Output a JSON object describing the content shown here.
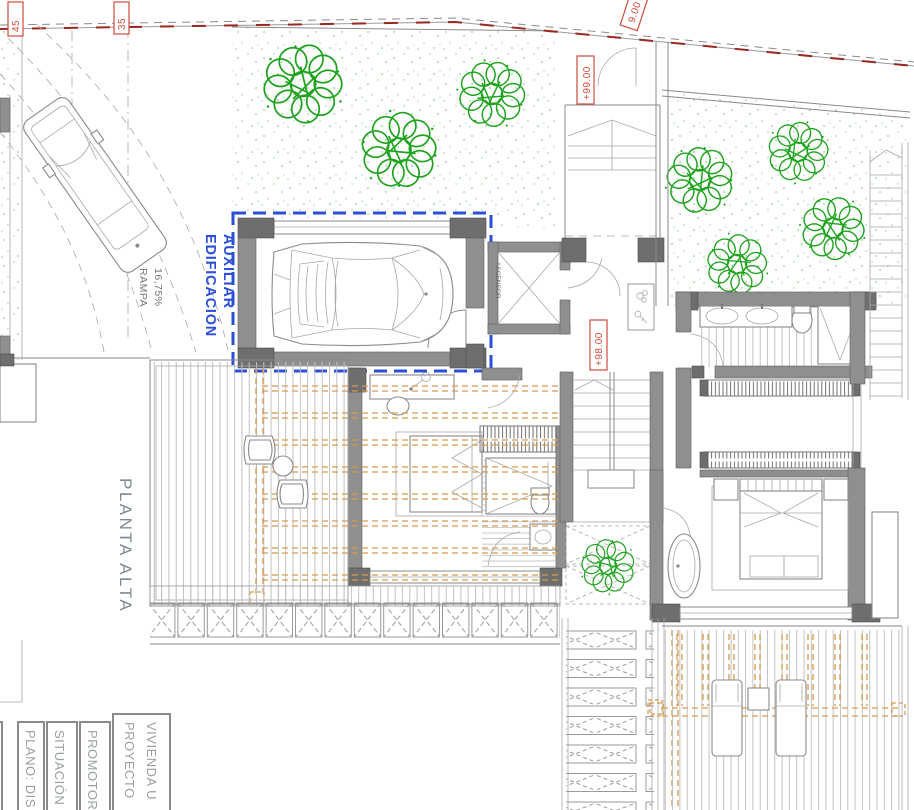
{
  "drawing": {
    "floor_label": "PLANTA ALTA",
    "aux_building_label_line1": "EDIFICACIÓN",
    "aux_building_label_line2": "AUXILIAR",
    "ramp_label_line1": "RAMPA",
    "ramp_label_line2": "16,75%",
    "elevator_label": "ASCENSOR",
    "levels": {
      "upper_garden": "+99.00",
      "main_floor": "+98.00"
    },
    "boundary_marks": {
      "mark_45": "45",
      "mark_35": "35",
      "dim_9": "9.00"
    }
  },
  "title_block": {
    "col_proyecto_line1": "PROYECTO",
    "col_proyecto_line2": "VIVIENDA U",
    "col_promotor": "PROMOTOR",
    "col_situacion": "SITUACIÓN",
    "col_plano": "PLANO: DIS"
  },
  "colors": {
    "boundary_red": "#992722",
    "label_red": "#d04a3a",
    "aux_blue": "#2b4fd8",
    "tree_green": "#1fa31f",
    "pergola_orange": "#d89a52",
    "wall_gray": "#8f8f8f",
    "wall_dark": "#6e6e6e",
    "line_gray": "#8a8a8a",
    "slat_gray": "#c2c2c2",
    "text_gray": "#9aa0a3"
  }
}
